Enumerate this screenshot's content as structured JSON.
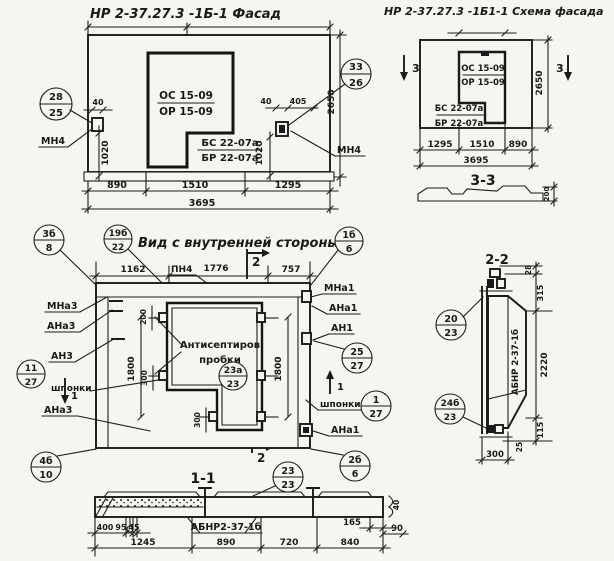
{
  "facade": {
    "title": "НР 2-37.27.3 -1Б-1 Фасад",
    "win_top": "ОС 15-09",
    "win_bot": "ОР 15-09",
    "sill_top": "БС 22-07а",
    "sill_bot": "БР 22-07а",
    "co_left_t": "28",
    "co_left_b": "25",
    "co_right_t": "33",
    "co_right_b": "26",
    "mn4_left": "МН4",
    "mn4_right": "МН4",
    "d40l": "40",
    "d40r": "40",
    "d405": "405",
    "d1020l": "1020",
    "d1020r": "1020",
    "d2650": "2650",
    "d890": "890",
    "d1510": "1510",
    "d1295": "1295",
    "d3695": "3695"
  },
  "scheme": {
    "title": "НР 2-37.27.3 -1Б1-1 Схема фасада",
    "win_top": "ОС 15-09",
    "win_bot": "ОР 15-09",
    "sill_top": "БС 22-07а",
    "sill_bot": "БР 22-07а",
    "d2650": "2650",
    "sec_l": "3",
    "sec_r": "3",
    "d1295": "1295",
    "d1510": "1510",
    "d890": "890",
    "d3695": "3695",
    "sec_label": "3-3",
    "d200": "200"
  },
  "inner": {
    "title": "Вид с внутренней стороны",
    "co_title_t": "19б",
    "co_title_b": "22",
    "co_tl_t": "3б",
    "co_tl_b": "8",
    "co_tr_t": "1б",
    "co_tr_b": "6",
    "d1162": "1162",
    "d1776": "1776",
    "d757": "757",
    "pn4": "ПН4",
    "cut2_top": "2",
    "cut2_bot": "2",
    "cut1_l": "1",
    "cut1_r": "1",
    "mna3": "МНа3",
    "ana3a": "АНа3",
    "an3": "АН3",
    "shponki_l": "шпонки",
    "ana3b": "АНа3",
    "co_sh_l_t": "11",
    "co_sh_l_b": "27",
    "co_4b_t": "4б",
    "co_4b_b": "10",
    "mna1": "МНа1",
    "ana1a": "АНа1",
    "an1": "АН1",
    "co_25_t": "25",
    "co_25_b": "27",
    "shponki_r": "шпонки",
    "co_sh_r_t": "1",
    "co_sh_r_b": "27",
    "ana1b": "АНа1",
    "co_2b_t": "2б",
    "co_2b_b": "6",
    "co_23a_t": "23а",
    "co_23a_b": "23",
    "note1": "Антисептиров",
    "note2": "пробки",
    "d1800l": "1800",
    "d1800r": "1800",
    "d200": "200",
    "d300a": "300",
    "d300b": "300"
  },
  "s11": {
    "title": "1-1",
    "co_t": "23",
    "co_b": "23",
    "mark": "АБНР2-37-1б",
    "d400": "400",
    "d95": "95",
    "d45": "45",
    "d165": "165",
    "d90": "90",
    "d40": "40",
    "d1245": "1245",
    "d890": "890",
    "d720": "720",
    "d840": "840"
  },
  "s22": {
    "title": "2-2",
    "mark": "АБНР 2-37-1б",
    "co1_t": "20",
    "co1_b": "23",
    "co2_t": "24б",
    "co2_b": "23",
    "d28": "28",
    "d315": "315",
    "d2220": "2220",
    "d115": "115",
    "d25": "25",
    "d300": "300"
  }
}
